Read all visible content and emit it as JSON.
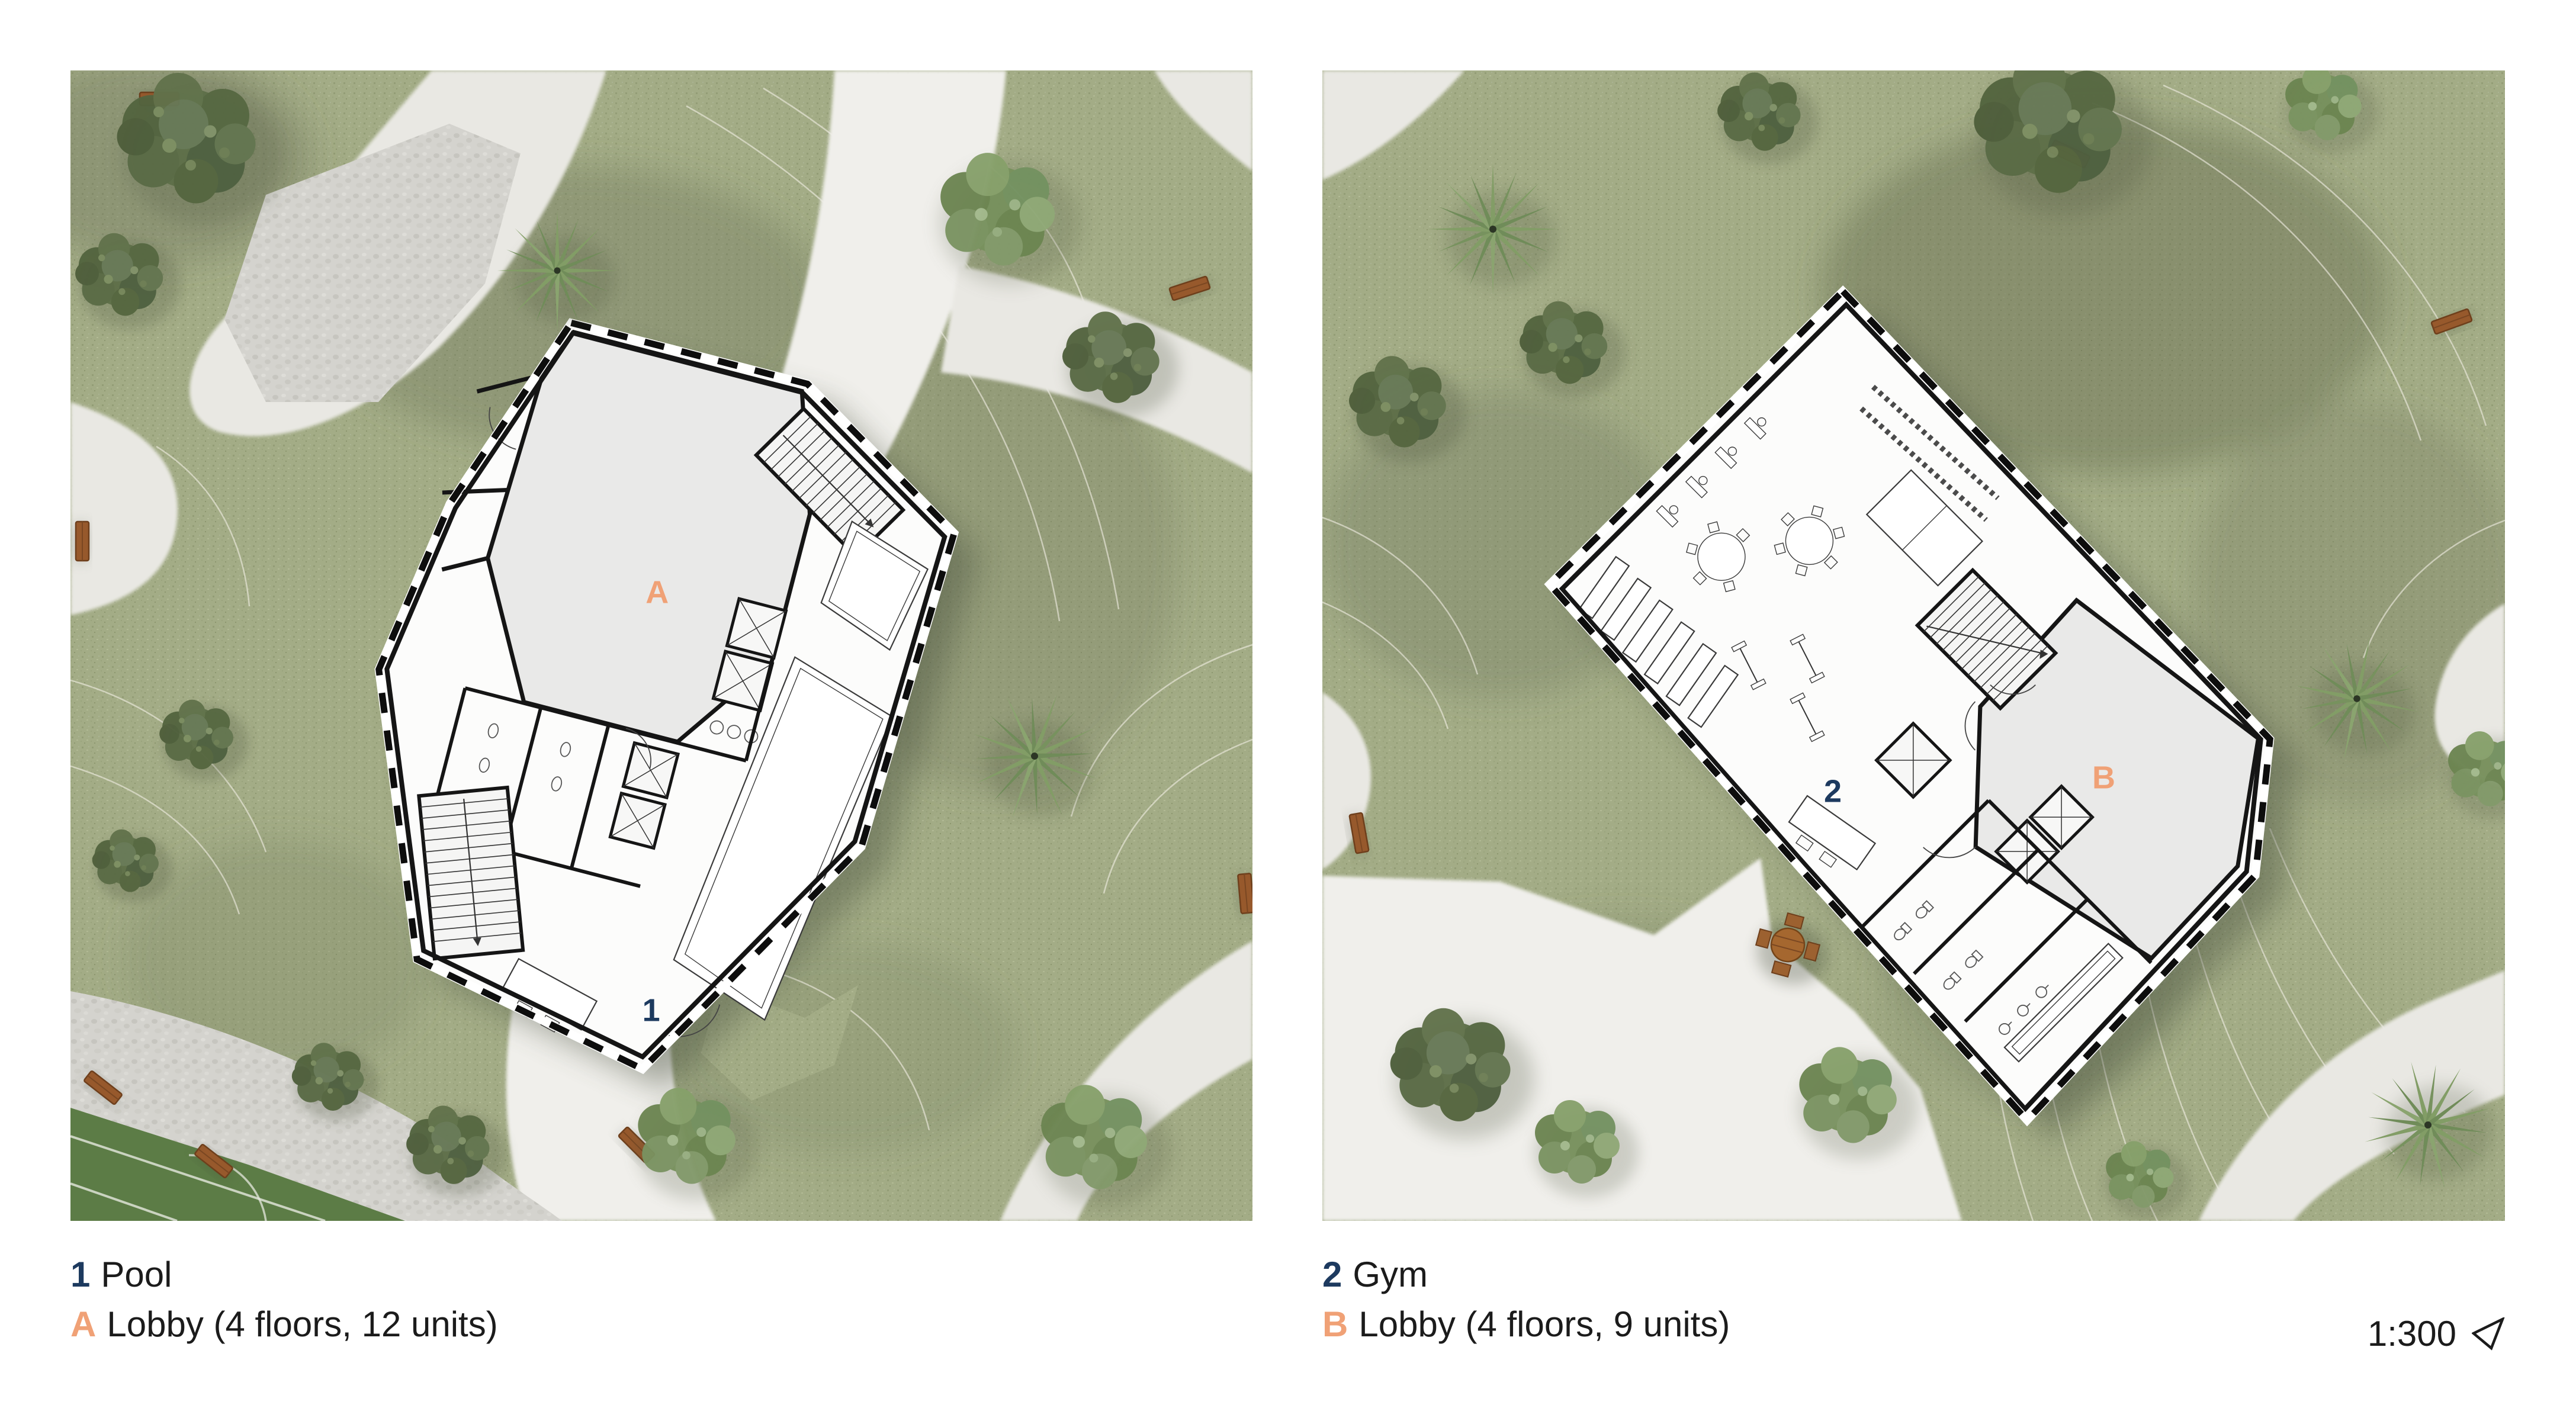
{
  "colors": {
    "accent_navy": "#1d3a5f",
    "accent_orange": "#f0a176",
    "text": "#1b1b1b",
    "grass_green": "#a3ac86",
    "path_gray": "#e9e8e3",
    "sports_field_green": "#5c7c46",
    "bench_brown": "#97592c"
  },
  "panels": [
    {
      "plan_labels": {
        "amenity": "1",
        "lobby": "A"
      },
      "legend": [
        {
          "key": "1",
          "label": "Pool"
        },
        {
          "key": "A",
          "label": "Lobby (4 floors, 12 units)"
        }
      ]
    },
    {
      "plan_labels": {
        "amenity": "2",
        "lobby": "B"
      },
      "legend": [
        {
          "key": "2",
          "label": "Gym"
        },
        {
          "key": "B",
          "label": "Lobby (4 floors, 9 units)"
        }
      ]
    }
  ],
  "footer": {
    "scale": "1:300",
    "north_icon": "north-arrow"
  }
}
